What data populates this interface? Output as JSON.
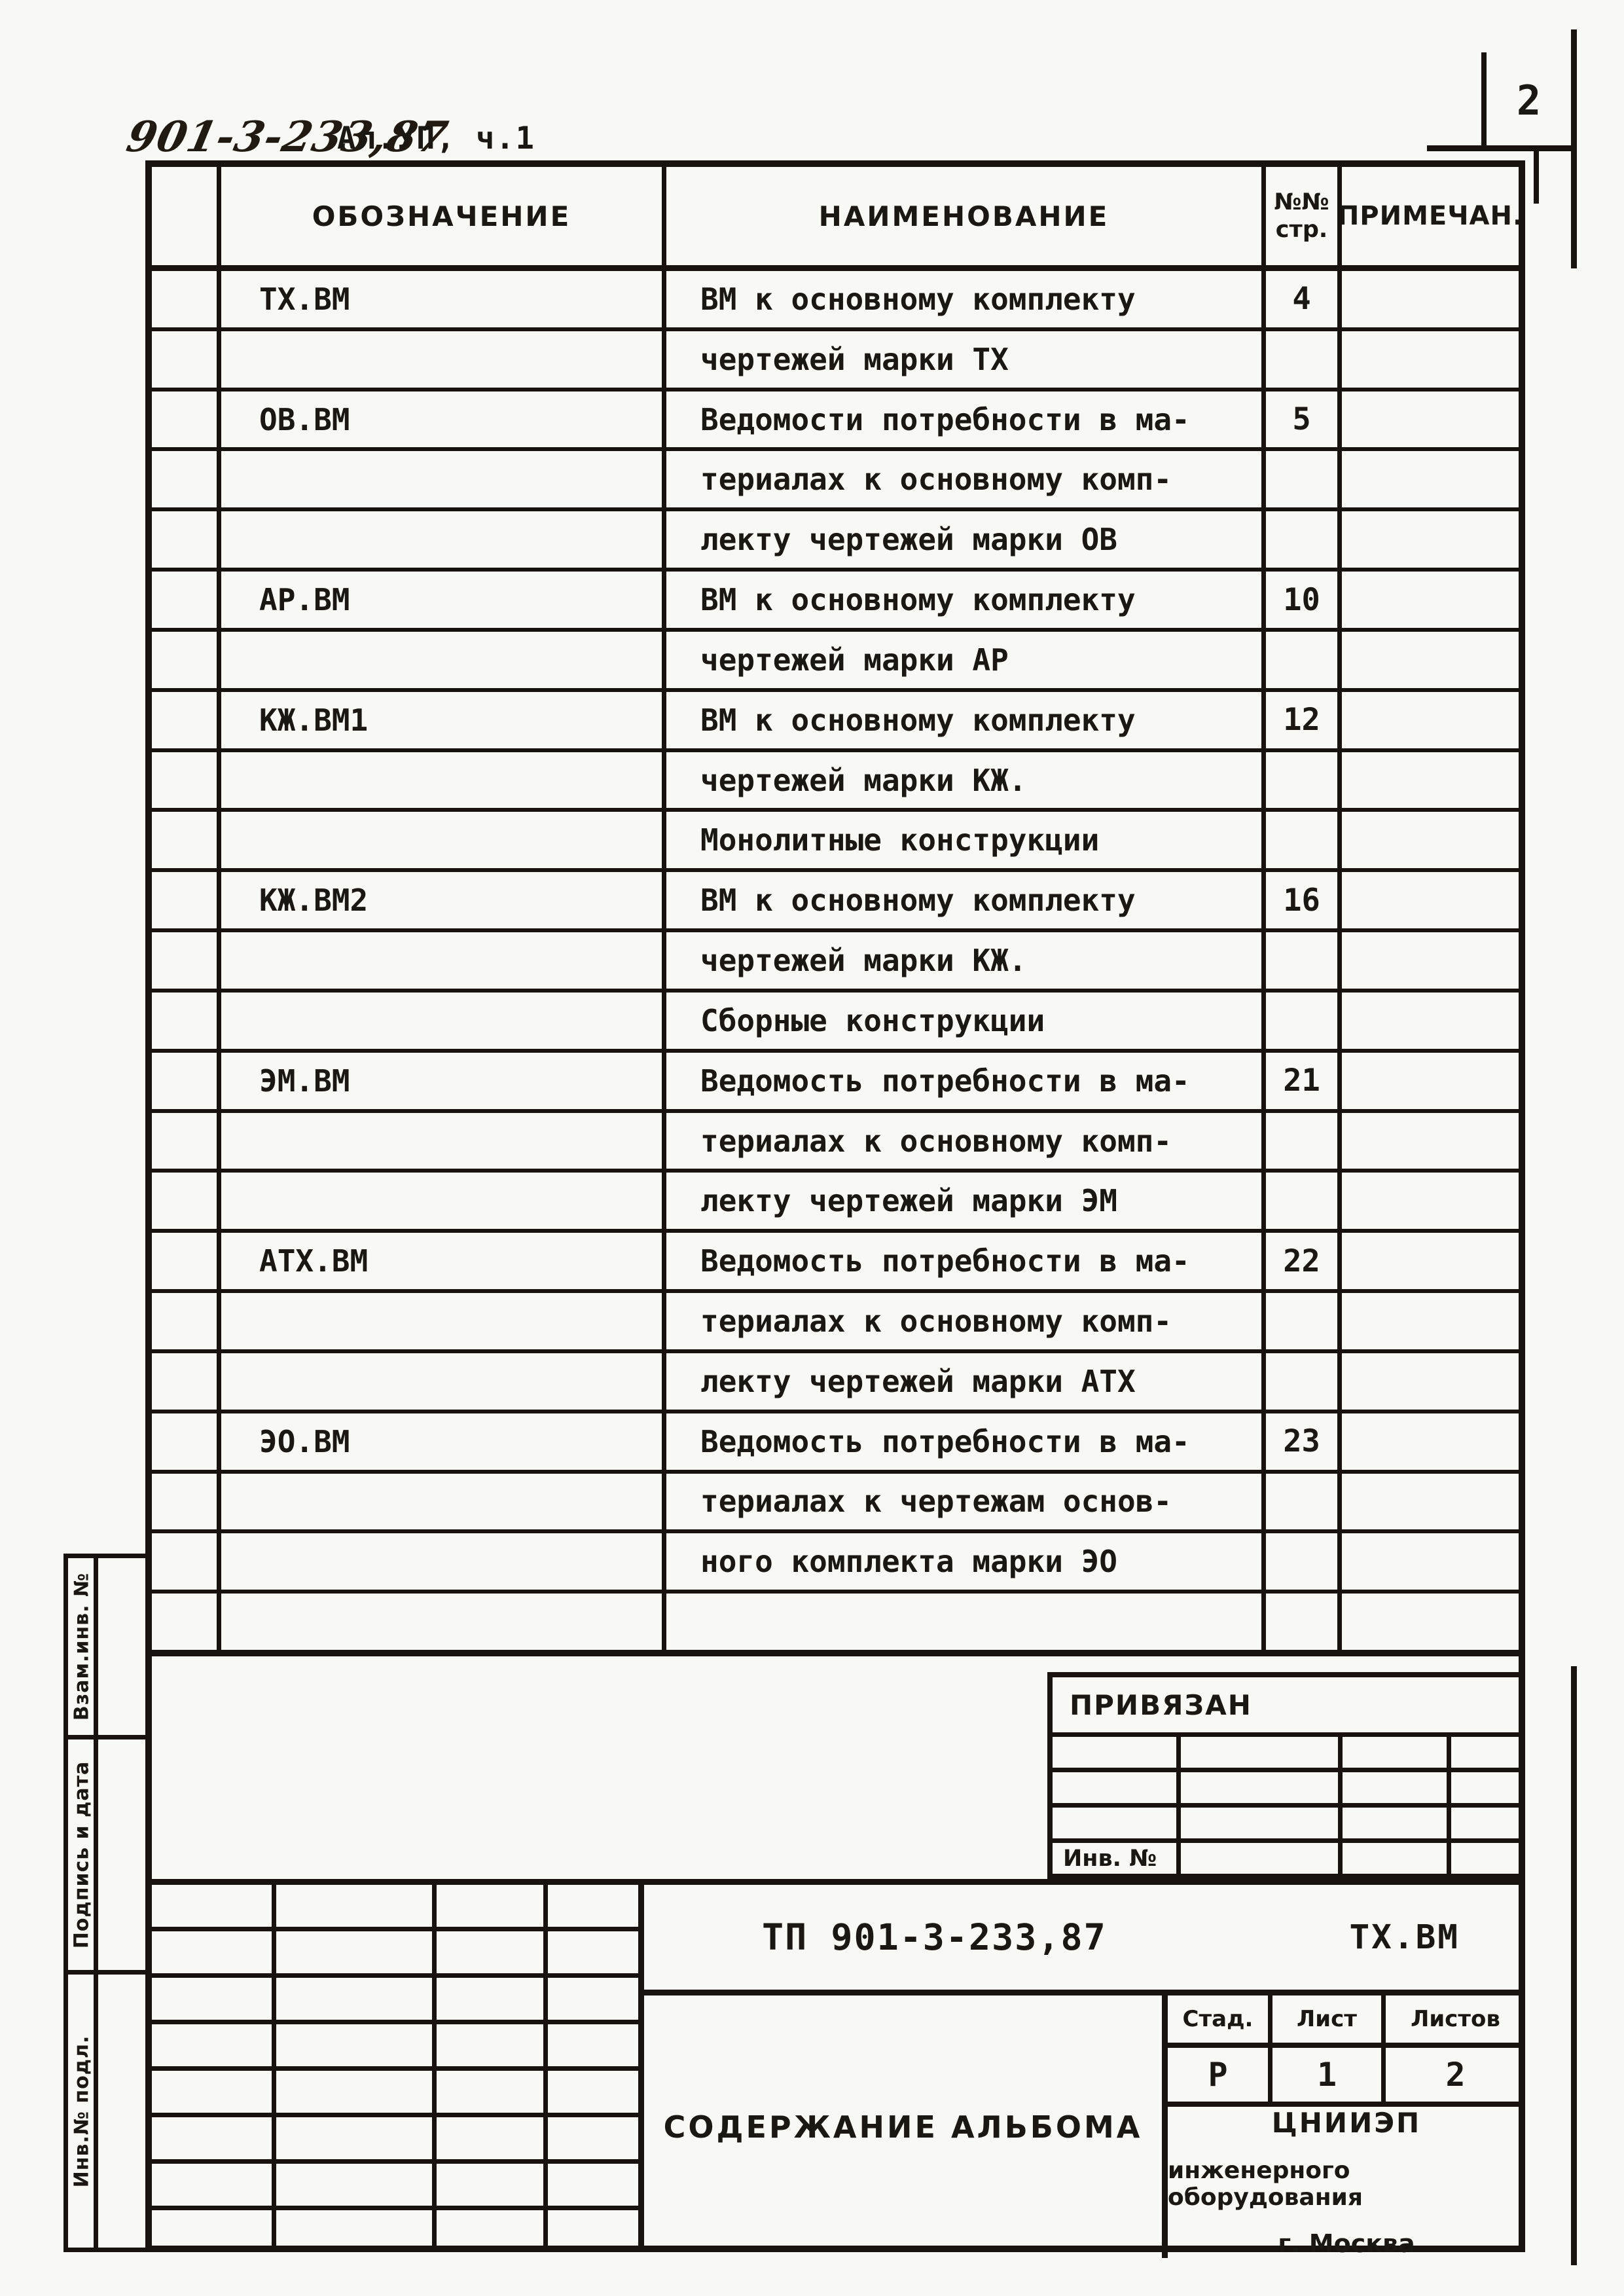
{
  "page": {
    "handwritten_code": "901-3-233,87",
    "album_part": "Ал.УП, ч.1",
    "page_number": "2"
  },
  "table": {
    "headers": {
      "designation": "ОБОЗНАЧЕНИЕ",
      "name": "НАИМЕНОВАНИЕ",
      "page_line1": "№№",
      "page_line2": "стр.",
      "note": "ПРИМЕЧАН."
    },
    "rows": [
      {
        "designation": "ТХ.ВМ",
        "name": "ВМ к основному комплекту",
        "page": "4"
      },
      {
        "designation": "",
        "name": "чертежей марки ТХ",
        "page": ""
      },
      {
        "designation": "ОВ.ВМ",
        "name": "Ведомости потребности в ма-",
        "page": "5"
      },
      {
        "designation": "",
        "name": "териалах к основному комп-",
        "page": ""
      },
      {
        "designation": "",
        "name": "лекту чертежей марки ОВ",
        "page": ""
      },
      {
        "designation": "АР.ВМ",
        "name": "ВМ к основному комплекту",
        "page": "10"
      },
      {
        "designation": "",
        "name": "чертежей марки АР",
        "page": ""
      },
      {
        "designation": "КЖ.ВМ1",
        "name": "ВМ к основному комплекту",
        "page": "12"
      },
      {
        "designation": "",
        "name": "чертежей марки КЖ.",
        "page": ""
      },
      {
        "designation": "",
        "name": "Монолитные конструкции",
        "page": ""
      },
      {
        "designation": "КЖ.ВМ2",
        "name": "ВМ к основному комплекту",
        "page": "16"
      },
      {
        "designation": "",
        "name": "чертежей марки КЖ.",
        "page": ""
      },
      {
        "designation": "",
        "name": "Сборные конструкции",
        "page": ""
      },
      {
        "designation": "ЭМ.ВМ",
        "name": "Ведомость потребности в ма-",
        "page": "21"
      },
      {
        "designation": "",
        "name": "териалах к основному комп-",
        "page": ""
      },
      {
        "designation": "",
        "name": "лекту чертежей марки ЭМ",
        "page": ""
      },
      {
        "designation": "АТХ.ВМ",
        "name": "Ведомость потребности в ма-",
        "page": "22"
      },
      {
        "designation": "",
        "name": "териалах к основному комп-",
        "page": ""
      },
      {
        "designation": "",
        "name": "лекту чертежей марки АТХ",
        "page": ""
      },
      {
        "designation": "ЭО.ВМ",
        "name": "Ведомость потребности в ма-",
        "page": "23"
      },
      {
        "designation": "",
        "name": "териалах к чертежам основ-",
        "page": ""
      },
      {
        "designation": "",
        "name": "ного комплекта марки ЭО",
        "page": ""
      },
      {
        "designation": "",
        "name": "",
        "page": ""
      }
    ]
  },
  "privyazan": {
    "title": "ПРИВЯЗАН",
    "inv_label": "Инв. №"
  },
  "titleblock": {
    "doc_code": "ТП 901-3-233,87",
    "doc_mark": "ТХ.ВМ",
    "album_title": "СОДЕРЖАНИЕ АЛЬБОМА",
    "stage_label": "Стад.",
    "sheet_label": "Лист",
    "sheets_label": "Листов",
    "stage_value": "Р",
    "sheet_value": "1",
    "sheets_value": "2",
    "org_line1": "ЦНИИЭП",
    "org_line2": "инженерного оборудования",
    "org_line3": "г. Москва"
  },
  "side": {
    "top": "Взам.инв. №",
    "middle": "Подпись и дата",
    "bottom": "Инв.№ подл."
  },
  "colors": {
    "ink": "#18130e",
    "paper": "#f8f8f4"
  }
}
